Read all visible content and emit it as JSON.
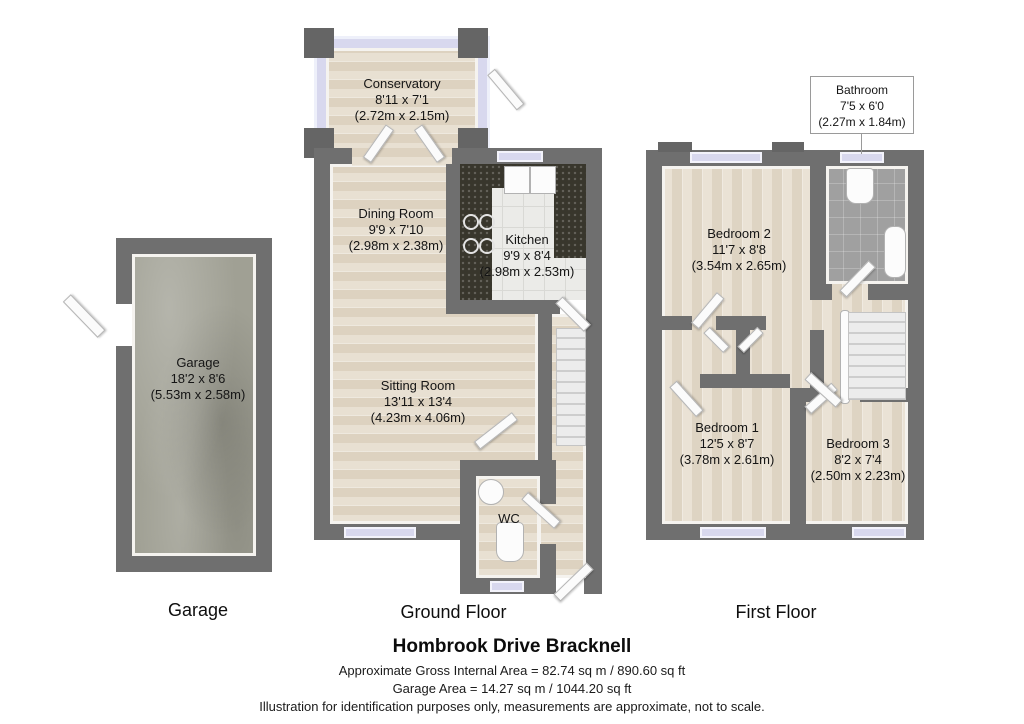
{
  "title": "Hombrook Drive Bracknell",
  "footer": {
    "area_line": "Approximate Gross Internal Area = 82.74 sq m / 890.60 sq ft",
    "garage_line": "Garage Area = 14.27 sq m / 1044.20 sq ft",
    "disclaimer": "Illustration for identification purposes only, measurements are approximate, not to scale."
  },
  "floor_labels": {
    "garage": "Garage",
    "ground": "Ground Floor",
    "first": "First Floor"
  },
  "rooms": {
    "garage": {
      "name": "Garage",
      "imperial": "18'2 x 8'6",
      "metric": "(5.53m x 2.58m)"
    },
    "conservatory": {
      "name": "Conservatory",
      "imperial": "8'11 x 7'1",
      "metric": "(2.72m x 2.15m)"
    },
    "dining_room": {
      "name": "Dining Room",
      "imperial": "9'9 x 7'10",
      "metric": "(2.98m x 2.38m)"
    },
    "kitchen": {
      "name": "Kitchen",
      "imperial": "9'9 x 8'4",
      "metric": "(2.98m x 2.53m)"
    },
    "sitting_room": {
      "name": "Sitting Room",
      "imperial": "13'11 x 13'4",
      "metric": "(4.23m x 4.06m)"
    },
    "wc": {
      "name": "WC"
    },
    "bathroom": {
      "name": "Bathroom",
      "imperial": "7'5 x 6'0",
      "metric": "(2.27m x 1.84m)"
    },
    "bedroom2": {
      "name": "Bedroom 2",
      "imperial": "11'7 x 8'8",
      "metric": "(3.54m x 2.65m)"
    },
    "bedroom1": {
      "name": "Bedroom 1",
      "imperial": "12'5 x 8'7",
      "metric": "(3.78m x 2.61m)"
    },
    "bedroom3": {
      "name": "Bedroom 3",
      "imperial": "8'2 x 7'4",
      "metric": "(2.50m x 2.23m)"
    }
  },
  "palette": {
    "wall": "#6f6f6f",
    "window": "#d8d8ee",
    "wood_floor": "#e4dbcc",
    "concrete_floor": "#a0a094",
    "kitchen_counter": "#38362c",
    "bath_floor": "#a0a0a0"
  }
}
